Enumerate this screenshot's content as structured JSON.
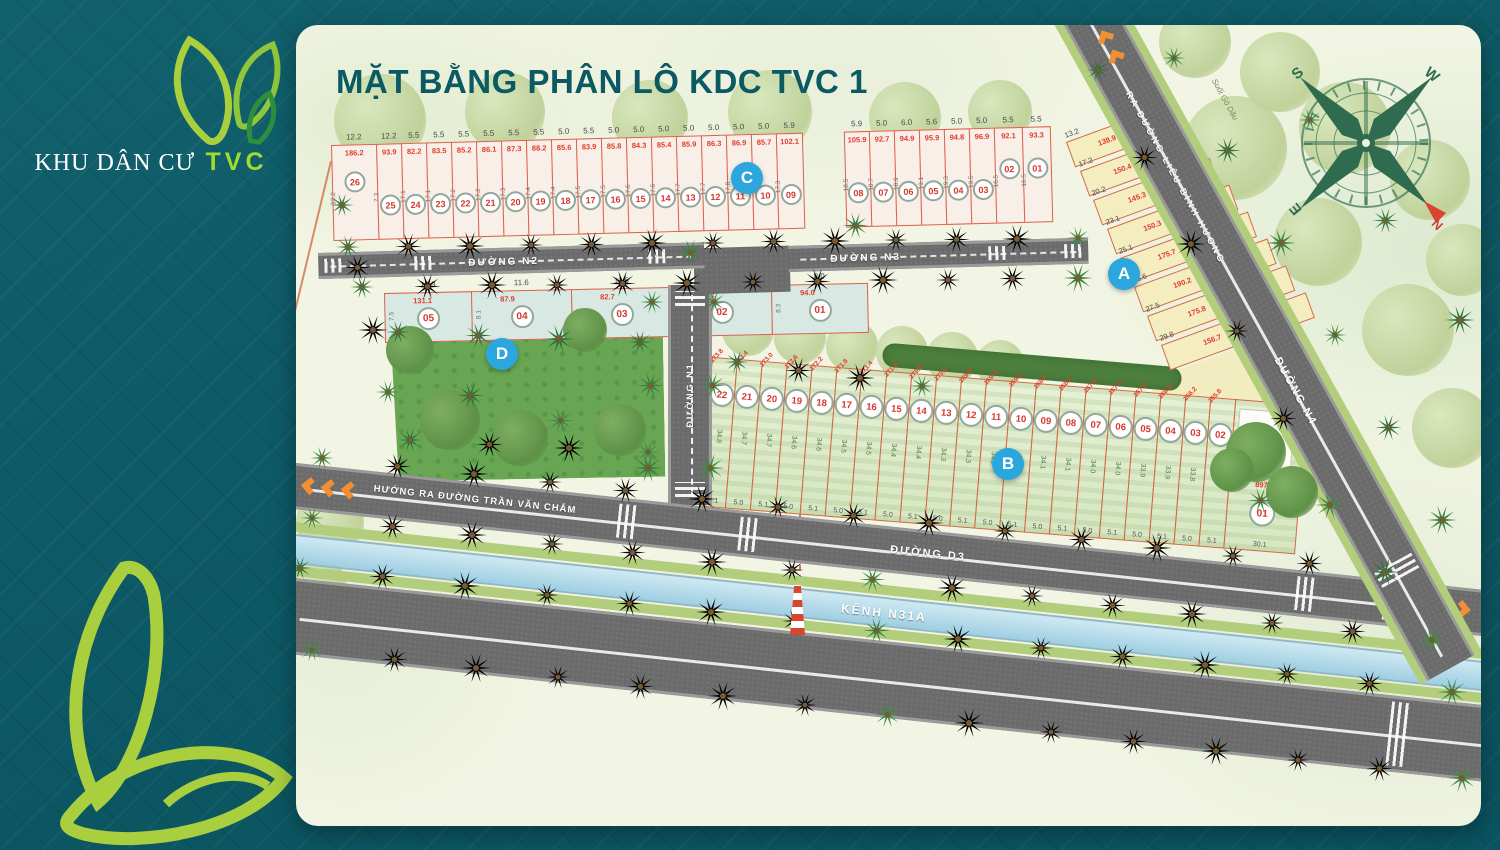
{
  "brand": {
    "prefix": "KHU DÂN CƯ",
    "suffix": "TVC"
  },
  "title": "MẶT BẰNG PHÂN LÔ KDC TVC 1",
  "compass": {
    "n": "N",
    "s": "S",
    "e": "E",
    "w": "W"
  },
  "roads": {
    "n1": "ĐƯỜNG N1",
    "n2": "ĐƯỜNG N2",
    "n3": "ĐƯỜNG N3",
    "n4": "ĐƯỜNG N4",
    "d3": "ĐƯỜNG D3",
    "canal": "KÊNH N31A",
    "exit_left": "HƯỚNG RA ĐƯỜNG TRẦN VĂN CHẮM",
    "exit_top": "RA ĐƯỜNG LIÊU BÌNH HƯƠNG",
    "stream": "Suối Gò Dầu"
  },
  "colors": {
    "teal_bg": "#0d5a66",
    "title": "#0a5963",
    "lime": "#a9ce3e",
    "lot_red": "#e23b2e",
    "badge_blue": "#2ba7dd",
    "road_gray": "#6b6b6b",
    "canal_blue": "#b7dcea",
    "block_a_fill": "#f3edc0",
    "block_b_fill": "#dfeccd",
    "block_c_fill": "#f8f0e8",
    "block_d_fill": "#d8e9e3"
  },
  "blocks": {
    "A": {
      "label": "A",
      "lots": [
        {
          "num": "01",
          "dim": "13.2",
          "area": "138.9"
        },
        {
          "num": "02",
          "dim": "17.2",
          "area": "150.4"
        },
        {
          "num": "03",
          "dim": "20.2",
          "area": "145.3"
        },
        {
          "num": "04",
          "dim": "23.1",
          "area": "150.3"
        },
        {
          "num": "05",
          "dim": "25.1",
          "area": "175.7"
        },
        {
          "num": "06",
          "dim": "26.6",
          "area": "190.2"
        },
        {
          "num": "07",
          "dim": "27.5",
          "area": "175.8"
        },
        {
          "num": "08",
          "dim": "29.8",
          "area": "156.7"
        }
      ]
    },
    "B": {
      "label": "B",
      "lots": [
        {
          "num": "22",
          "area": "173.8",
          "side": "34.8",
          "bot": "5.1"
        },
        {
          "num": "21",
          "area": "173.4",
          "side": "34.7",
          "bot": "5.0"
        },
        {
          "num": "20",
          "area": "173.0",
          "side": "34.7",
          "bot": "5.1"
        },
        {
          "num": "19",
          "area": "172.6",
          "side": "34.6",
          "bot": "5.0"
        },
        {
          "num": "18",
          "area": "172.2",
          "side": "34.6",
          "bot": "5.1"
        },
        {
          "num": "17",
          "area": "171.8",
          "side": "34.5",
          "bot": "5.0"
        },
        {
          "num": "16",
          "area": "171.4",
          "side": "34.5",
          "bot": "5.1"
        },
        {
          "num": "15",
          "area": "171.0",
          "side": "34.4",
          "bot": "5.0"
        },
        {
          "num": "14",
          "area": "170.6",
          "side": "34.4",
          "bot": "5.1"
        },
        {
          "num": "13",
          "area": "170.2",
          "side": "34.3",
          "bot": "5.0"
        },
        {
          "num": "12",
          "area": "169.8",
          "side": "34.3",
          "bot": "5.1"
        },
        {
          "num": "11",
          "area": "169.4",
          "side": "34.2",
          "bot": "5.0"
        },
        {
          "num": "10",
          "area": "169.0",
          "side": "34.2",
          "bot": "5.1"
        },
        {
          "num": "09",
          "area": "168.6",
          "side": "34.1",
          "bot": "5.0"
        },
        {
          "num": "08",
          "area": "168.2",
          "side": "34.1",
          "bot": "5.1"
        },
        {
          "num": "07",
          "area": "167.8",
          "side": "34.0",
          "bot": "5.0"
        },
        {
          "num": "06",
          "area": "167.4",
          "side": "34.0",
          "bot": "5.1"
        },
        {
          "num": "05",
          "area": "167.0",
          "side": "33.9",
          "bot": "5.0"
        },
        {
          "num": "04",
          "area": "166.6",
          "side": "33.9",
          "bot": "5.1"
        },
        {
          "num": "03",
          "area": "166.2",
          "side": "33.8",
          "bot": "5.0"
        },
        {
          "num": "02",
          "area": "165.8",
          "side": "33.8",
          "bot": "5.1"
        },
        {
          "num": "01",
          "area": "897.8",
          "side": "35.1",
          "bot": "30.1"
        }
      ]
    },
    "C": {
      "label": "C",
      "lots": [
        {
          "num": "26",
          "top": "12.2",
          "area": "186.2",
          "side": "12.2"
        },
        {
          "num": "25",
          "top": "12.2",
          "area": "93.9",
          "side": "7.3"
        },
        {
          "num": "24",
          "top": "5.5",
          "area": "82.2",
          "side": "17.1"
        },
        {
          "num": "23",
          "top": "5.5",
          "area": "83.5",
          "side": "17.1"
        },
        {
          "num": "22",
          "top": "5.5",
          "area": "85.2",
          "side": "17.2"
        },
        {
          "num": "21",
          "top": "5.5",
          "area": "86.1",
          "side": "17.2"
        },
        {
          "num": "20",
          "top": "5.5",
          "area": "87.3",
          "side": "17.3"
        },
        {
          "num": "19",
          "top": "5.5",
          "area": "88.2",
          "side": "17.4"
        },
        {
          "num": "18",
          "top": "5.0",
          "area": "85.6",
          "side": "17.4"
        },
        {
          "num": "17",
          "top": "5.5",
          "area": "83.9",
          "side": "17.5"
        },
        {
          "num": "16",
          "top": "5.0",
          "area": "85.8",
          "side": "17.5"
        },
        {
          "num": "15",
          "top": "5.0",
          "area": "84.3",
          "side": "17.6"
        },
        {
          "num": "14",
          "top": "5.0",
          "area": "85.4",
          "side": "17.6"
        },
        {
          "num": "13",
          "top": "5.0",
          "area": "85.9",
          "side": "17.7"
        },
        {
          "num": "12",
          "top": "5.0",
          "area": "86.3",
          "side": "17.7"
        },
        {
          "num": "11",
          "top": "5.0",
          "area": "86.9",
          "side": "17.8"
        },
        {
          "num": "10",
          "top": "5.0",
          "area": "85.7",
          "side": "17.8"
        },
        {
          "num": "09",
          "top": "5.9",
          "area": "102.1",
          "side": "17.3"
        },
        {
          "num": "08",
          "top": "5.9",
          "area": "105.9",
          "side": "18.5"
        },
        {
          "num": "07",
          "top": "5.0",
          "area": "92.7",
          "side": "18.7"
        },
        {
          "num": "06",
          "top": "6.0",
          "area": "94.9",
          "side": "18.9"
        },
        {
          "num": "05",
          "top": "5.6",
          "area": "95.9",
          "side": "19.1"
        },
        {
          "num": "04",
          "top": "5.0",
          "area": "94.8",
          "side": "19.3"
        },
        {
          "num": "03",
          "top": "5.0",
          "area": "96.9",
          "side": "19.5"
        },
        {
          "num": "02",
          "top": "5.5",
          "area": "92.1",
          "side": "16.5"
        },
        {
          "num": "01",
          "top": "5.5",
          "area": "93.3",
          "side": "16.5"
        }
      ]
    },
    "D": {
      "label": "D",
      "lots": [
        {
          "num": "05",
          "top": "10.3",
          "area": "131.1",
          "side": "7.5"
        },
        {
          "num": "04",
          "top": "11.6",
          "area": "87.9",
          "side": "8.1"
        },
        {
          "num": "03",
          "top": "11.5",
          "area": "82.7",
          "side": "8.1"
        },
        {
          "num": "02",
          "top": "11.6",
          "area": "92.2",
          "side": "8.1"
        },
        {
          "num": "01",
          "top": "8.0",
          "area": "94.0",
          "side": "8.3"
        }
      ]
    }
  }
}
